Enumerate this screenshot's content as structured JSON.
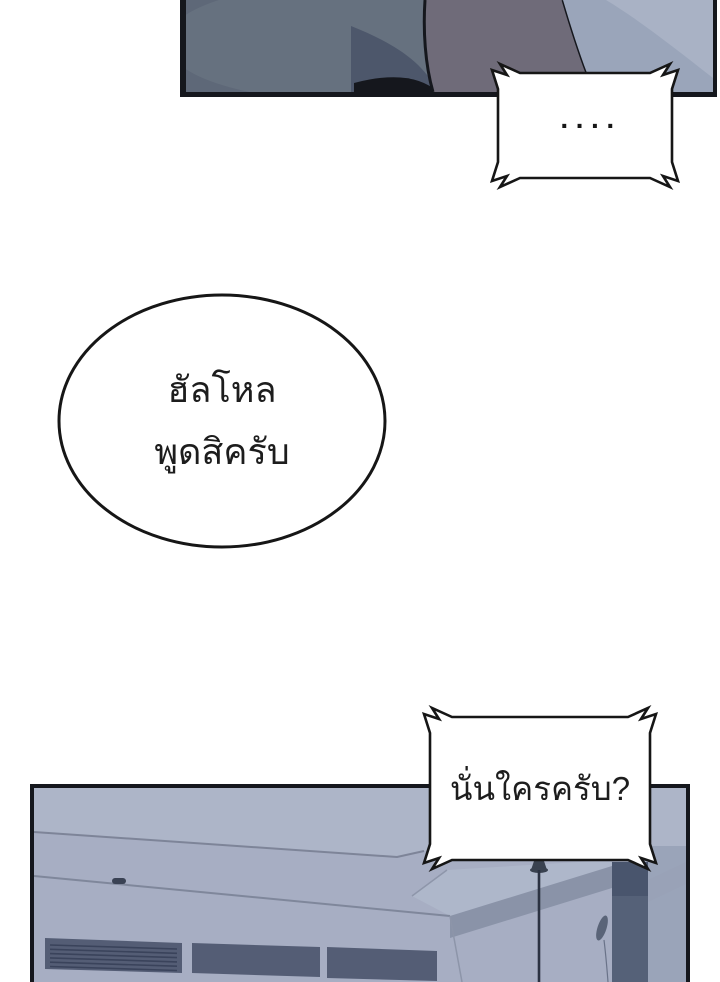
{
  "page_title": "Webtoon comic page",
  "palette": {
    "ink": "#15171d",
    "paper": "#ffffff",
    "bubble_fill": "#ffffff",
    "bubble_stroke": "#161616",
    "text_color": "#1d1d1d",
    "fabric_base": "#5e6878",
    "fabric_light": "#6a7482",
    "fabric_shadow": "#4d576b",
    "sleeve": "#6f6b79",
    "backdrop_light": "#9aa5ba",
    "backdrop_lighter": "#a9b2c5",
    "wall": "#a7aec3",
    "ceiling": "#adb5c8",
    "ceiling_line": "#757d91",
    "far_wall": "#aeb7ca",
    "wall_band": "#8a93a8",
    "column": "#556178",
    "right_wall": "#9aa4b9",
    "vent": "#545d75",
    "vent_slat": "#3a435b",
    "fixture": "#39414f",
    "cord": "#2b3242"
  },
  "bubbles": {
    "silence": {
      "text": "····"
    },
    "hello": {
      "line1": "ฮัลโหล",
      "line2": "พูดสิครับ"
    },
    "question": {
      "text": "นั่นใครครับ?"
    }
  }
}
